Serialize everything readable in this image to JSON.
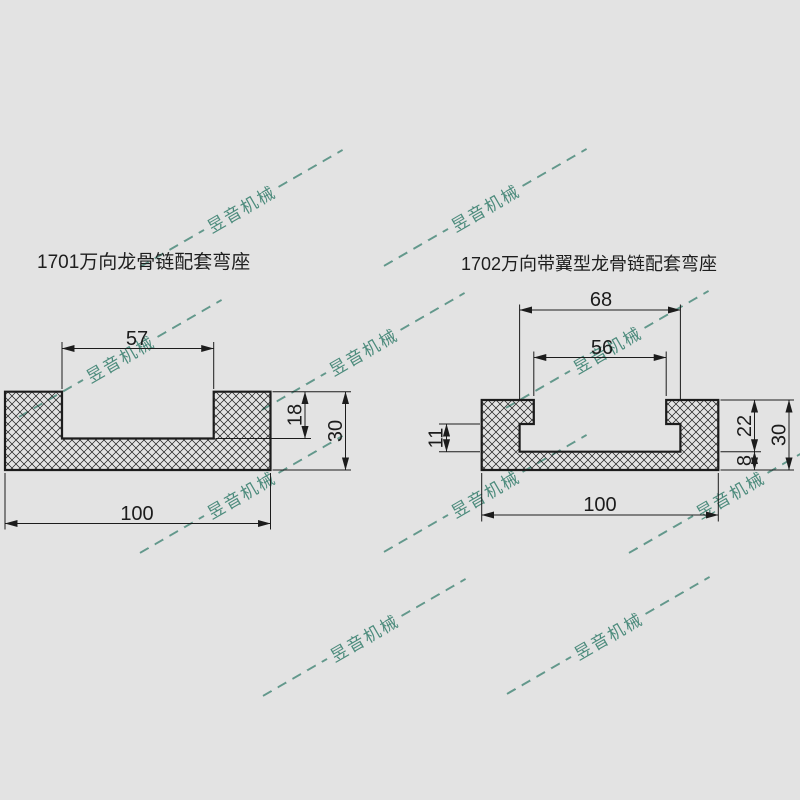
{
  "page": {
    "background_color": "#e3e3e3",
    "line_color": "#1c1c1c",
    "watermark_color": "#4c8b7c"
  },
  "watermark": {
    "text": "昱音机械"
  },
  "drawings": {
    "left": {
      "title": "1701万向龙骨链配套弯座",
      "dims": {
        "opening_width": "57",
        "base_width": "100",
        "groove_depth": "18",
        "total_height": "30"
      }
    },
    "right": {
      "title": "1702万向带翼型龙骨链配套弯座",
      "dims": {
        "tower_gap": "68",
        "wing_gap": "56",
        "base_width": "100",
        "side_step": "11",
        "upper_height": "22",
        "base_thickness": "8",
        "total_height": "30"
      }
    }
  }
}
